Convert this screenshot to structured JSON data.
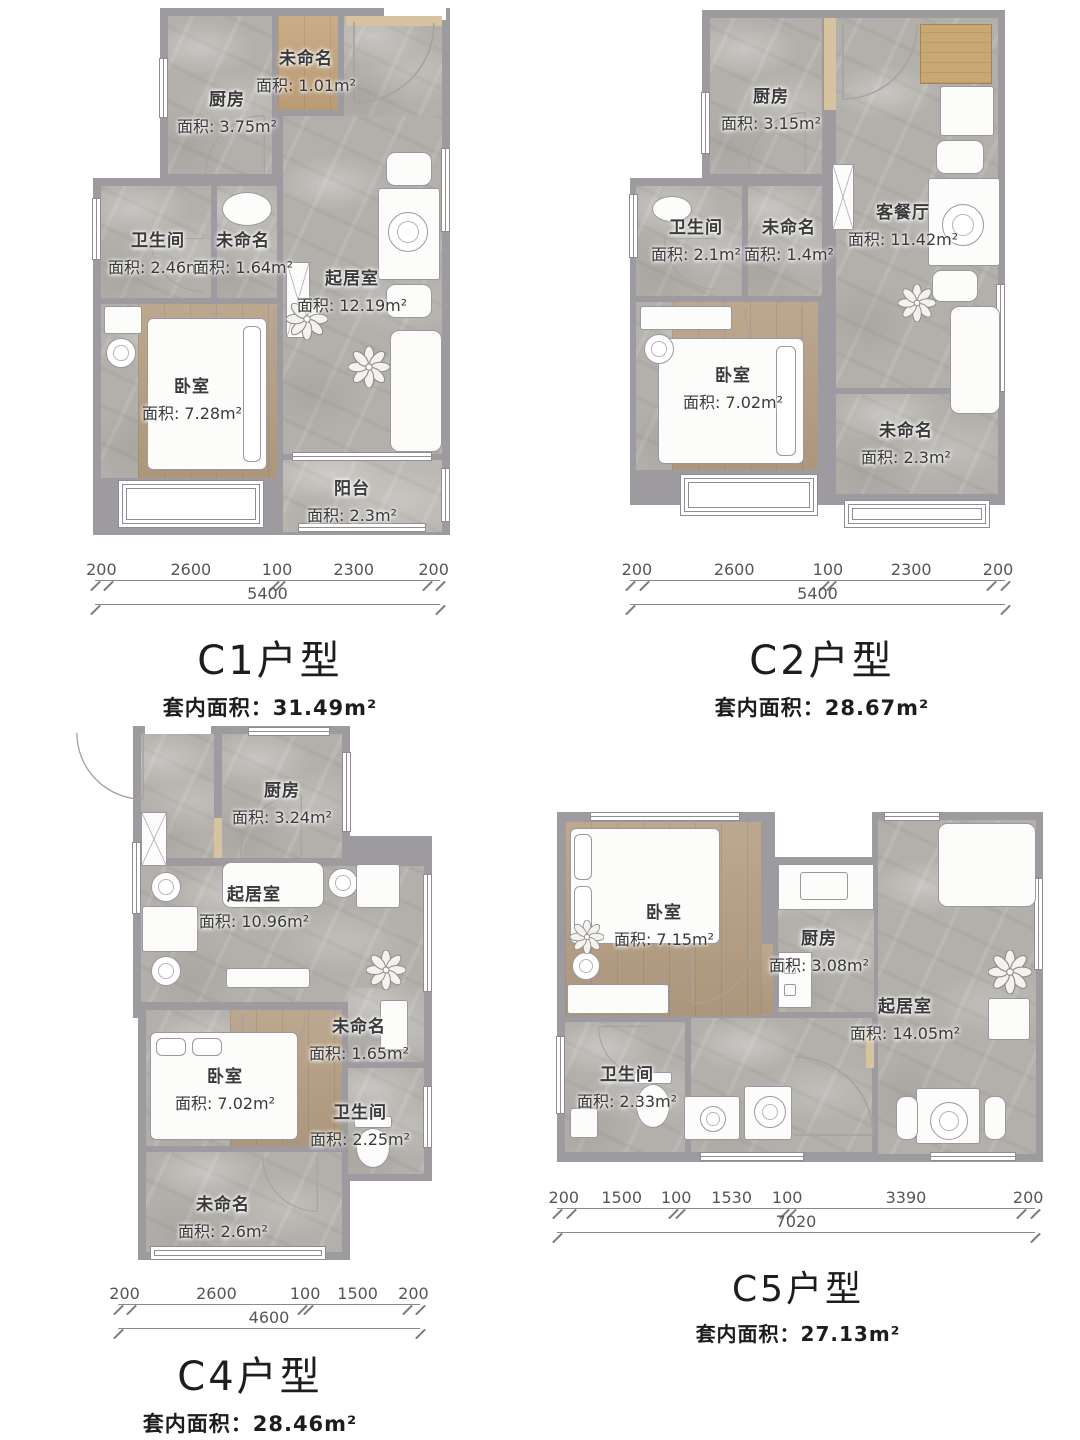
{
  "sheet": {
    "description_colors": {
      "wall": "#9d9aa0",
      "marble_floor": "#b3b0ab",
      "wood_floor": "#b59e83",
      "threshold_tan": "#d8c3a0",
      "cabinet_tan": "#c9a873"
    }
  },
  "plans": {
    "c1": {
      "title": "C1户型",
      "area_label": "套内面积：31.49m²",
      "rooms": [
        {
          "name": "未命名",
          "area": "面积: 1.01m²"
        },
        {
          "name": "厨房",
          "area": "面积: 3.75m²"
        },
        {
          "name": "卫生间",
          "area": "面积: 2.46m²"
        },
        {
          "name": "未命名",
          "area": "面积: 1.64m²"
        },
        {
          "name": "起居室",
          "area": "面积: 12.19m²"
        },
        {
          "name": "卧室",
          "area": "面积: 7.28m²"
        },
        {
          "name": "阳台",
          "area": "面积: 2.3m²"
        }
      ],
      "dims": {
        "segments": [
          "200",
          "2600",
          "100",
          "2300",
          "200"
        ],
        "total": "5400"
      }
    },
    "c2": {
      "title": "C2户型",
      "area_label": "套内面积：28.67m²",
      "rooms": [
        {
          "name": "厨房",
          "area": "面积: 3.15m²"
        },
        {
          "name": "卫生间",
          "area": "面积: 2.1m²"
        },
        {
          "name": "未命名",
          "area": "面积: 1.4m²"
        },
        {
          "name": "客餐厅",
          "area": "面积: 11.42m²"
        },
        {
          "name": "卧室",
          "area": "面积: 7.02m²"
        },
        {
          "name": "未命名",
          "area": "面积: 2.3m²"
        }
      ],
      "dims": {
        "segments": [
          "200",
          "2600",
          "100",
          "2300",
          "200"
        ],
        "total": "5400"
      }
    },
    "c4": {
      "title": "C4户型",
      "area_label": "套内面积：28.46m²",
      "rooms": [
        {
          "name": "厨房",
          "area": "面积: 3.24m²"
        },
        {
          "name": "起居室",
          "area": "面积: 10.96m²"
        },
        {
          "name": "未命名",
          "area": "面积: 1.65m²"
        },
        {
          "name": "卧室",
          "area": "面积: 7.02m²"
        },
        {
          "name": "卫生间",
          "area": "面积: 2.25m²"
        },
        {
          "name": "未命名",
          "area": "面积: 2.6m²"
        }
      ],
      "dims": {
        "segments": [
          "200",
          "2600",
          "100",
          "1500",
          "200"
        ],
        "total": "4600"
      }
    },
    "c5": {
      "title": "C5户型",
      "area_label": "套内面积：27.13m²",
      "rooms": [
        {
          "name": "卧室",
          "area": "面积: 7.15m²"
        },
        {
          "name": "厨房",
          "area": "面积: 3.08m²"
        },
        {
          "name": "起居室",
          "area": "面积: 14.05m²"
        },
        {
          "name": "卫生间",
          "area": "面积: 2.33m²"
        }
      ],
      "dims": {
        "segments": [
          "200",
          "1500",
          "100",
          "1530",
          "100",
          "3390",
          "200"
        ],
        "total": "7020"
      }
    }
  }
}
